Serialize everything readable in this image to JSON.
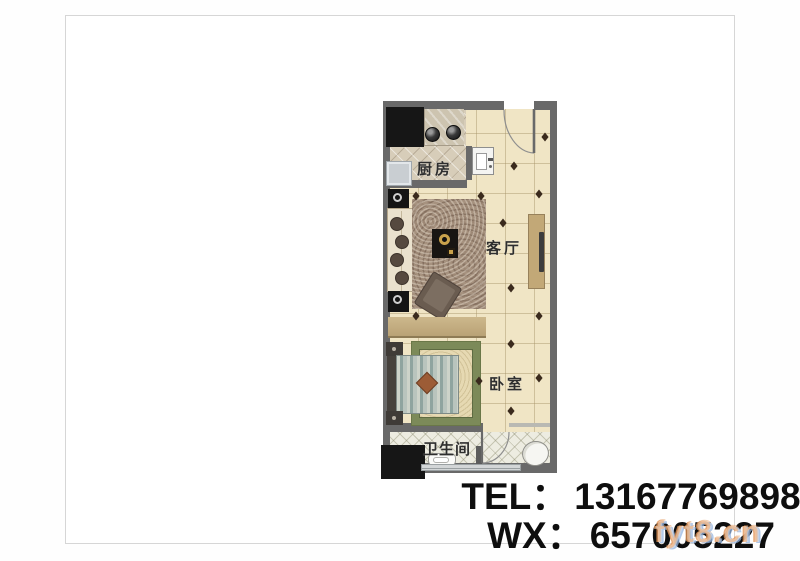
{
  "floor_plan": {
    "rooms": [
      {
        "id": "kitchen",
        "label": "厨房"
      },
      {
        "id": "living_room",
        "label": "客厅"
      },
      {
        "id": "bedroom",
        "label": "卧室"
      },
      {
        "id": "bathroom",
        "label": "卫生间"
      }
    ]
  },
  "contact": {
    "tel_label": "TEL：",
    "tel_value": "13167769898",
    "wx_label": "WX：",
    "wx_value": "657005227"
  },
  "watermark": "fyt8.cn",
  "colors": {
    "wall": "#696969",
    "floor_cream": "#f0e5c5",
    "floor_kitchen": "#d7cdb9",
    "floor_bath": "#edece1",
    "wood_accent": "#c2a877",
    "black_block": "#161616",
    "bedroom_rug_green": "#7c8a59",
    "living_rug_brown": "#a6927f",
    "diamond_accent": "#3a2a1d",
    "text_dark": "#0e0e0e"
  }
}
